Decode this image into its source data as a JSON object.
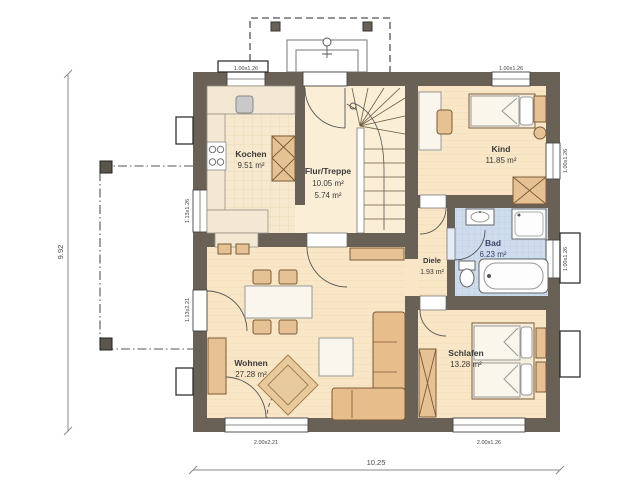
{
  "plan": {
    "rooms": {
      "kochen": {
        "name": "Kochen",
        "area": "9.51 m²"
      },
      "flur_treppe": {
        "name": "Flur/Treppe",
        "area1": "10.05 m²",
        "area2": "5.74 m²"
      },
      "kind": {
        "name": "Kind",
        "area": "11.85 m²"
      },
      "bad": {
        "name": "Bad",
        "area": "6.23 m²"
      },
      "diele": {
        "name": "Diele",
        "area": "1.93 m²"
      },
      "wohnen": {
        "name": "Wohnen",
        "area": "27.28 m²"
      },
      "schlafen": {
        "name": "Schlafen",
        "area": "13.28 m²"
      }
    },
    "dimensions": {
      "total_depth": "9.92",
      "total_width": "10.25"
    },
    "openings": {
      "kochen_window": "1.00x1.26",
      "kind_window_top": "1.00x1.26",
      "kind_window_right": "1.00x1.26",
      "bad_window": "1.00x1.26",
      "wohnen_window_left": "1.13x1.26",
      "terrace_door": "1.13x2.21",
      "wohnen_door_bottom": "2.00x2.21",
      "schlafen_window": "2.00x1.26"
    },
    "colors": {
      "wall": "#6a6156",
      "floor": "#f8e6c6",
      "bath_floor": "#cfdcee",
      "furniture": "#e6c193"
    }
  }
}
